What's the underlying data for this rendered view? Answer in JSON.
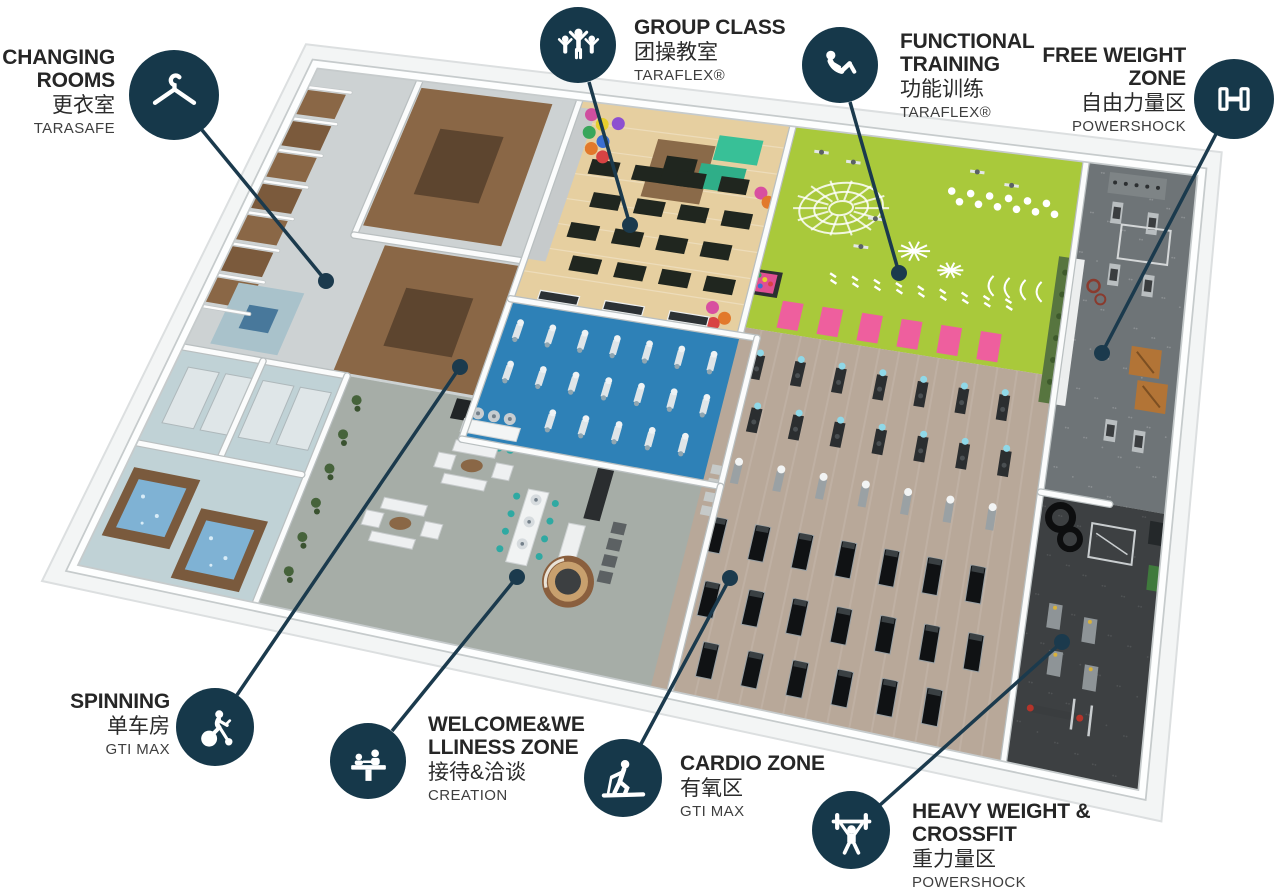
{
  "page": {
    "width": 1280,
    "height": 889,
    "background": "#ffffff"
  },
  "colors": {
    "label_circle": "#16384a",
    "leader_line": "#1b3a4d",
    "title_text": "#262626",
    "cn_text": "#2b2b2b",
    "brand_text": "#3e3e3e",
    "accent_pink": "#ee5f9e",
    "accent_teal": "#38c097",
    "wood_brown": "#8a6746"
  },
  "zones": [
    {
      "id": "changing-rooms",
      "color": "#cdd2d3"
    },
    {
      "id": "wet-area",
      "color": "#c0d2d6"
    },
    {
      "id": "welcome-wellness",
      "color": "#a6ada7"
    },
    {
      "id": "group-class",
      "color": "#e6cfa0"
    },
    {
      "id": "spinning",
      "color": "#2e81b7"
    },
    {
      "id": "functional-training",
      "color": "#a9c93b"
    },
    {
      "id": "cardio",
      "color": "#b8a899"
    },
    {
      "id": "free-weight",
      "color": "#6e7477"
    },
    {
      "id": "heavy-weight-crossfit",
      "color": "#3d4042"
    }
  ],
  "labels": [
    {
      "id": "changing-rooms",
      "title_lines": [
        "CHANGING",
        "ROOMS"
      ],
      "cn": "更衣室",
      "brand": "TARASAFE",
      "icon": "hanger-icon",
      "side": "right",
      "anchor_x": 115,
      "text_top": 46,
      "circle": {
        "x": 174,
        "y": 95,
        "r": 45
      },
      "leader": {
        "x1": 202,
        "y1": 130,
        "x2": 326,
        "y2": 281
      }
    },
    {
      "id": "group-class",
      "title_lines": [
        "GROUP CLASS"
      ],
      "cn": "团操教室",
      "brand": "TARAFLEX®",
      "icon": "group-class-icon",
      "side": "left",
      "anchor_x": 634,
      "text_top": 16,
      "circle": {
        "x": 578,
        "y": 45,
        "r": 38
      },
      "leader": {
        "x1": 589,
        "y1": 82,
        "x2": 630,
        "y2": 225
      }
    },
    {
      "id": "functional-training",
      "title_lines": [
        "FUNCTIONAL",
        "TRAINING"
      ],
      "cn": "功能训练",
      "brand": "TARAFLEX®",
      "icon": "situp-icon",
      "side": "left",
      "anchor_x": 900,
      "text_top": 30,
      "circle": {
        "x": 840,
        "y": 65,
        "r": 38
      },
      "leader": {
        "x1": 850,
        "y1": 102,
        "x2": 899,
        "y2": 273
      }
    },
    {
      "id": "free-weight-zone",
      "title_lines": [
        "FREE WEIGHT",
        "ZONE"
      ],
      "cn": "自由力量区",
      "brand": "POWERSHOCK",
      "icon": "dumbbell-icon",
      "side": "right",
      "anchor_x": 1186,
      "text_top": 44,
      "circle": {
        "x": 1234,
        "y": 99,
        "r": 40
      },
      "leader": {
        "x1": 1216,
        "y1": 134,
        "x2": 1102,
        "y2": 353
      }
    },
    {
      "id": "spinning",
      "title_lines": [
        "SPINNING"
      ],
      "cn": "单车房",
      "brand": "GTI MAX",
      "icon": "spin-bike-icon",
      "side": "right",
      "anchor_x": 170,
      "text_top": 690,
      "circle": {
        "x": 215,
        "y": 727,
        "r": 39
      },
      "leader": {
        "x1": 237,
        "y1": 695,
        "x2": 460,
        "y2": 367
      }
    },
    {
      "id": "welcome-wellness",
      "title_lines": [
        "WELCOME&WE",
        "LLINESS ZONE"
      ],
      "cn": "接待&洽谈",
      "brand": "CREATION",
      "icon": "reception-icon",
      "side": "left",
      "anchor_x": 428,
      "text_top": 713,
      "circle": {
        "x": 368,
        "y": 761,
        "r": 38
      },
      "leader": {
        "x1": 392,
        "y1": 731,
        "x2": 517,
        "y2": 577
      }
    },
    {
      "id": "cardio-zone",
      "title_lines": [
        "CARDIO ZONE"
      ],
      "cn": "有氧区",
      "brand": "GTI MAX",
      "icon": "treadmill-icon",
      "side": "left",
      "anchor_x": 680,
      "text_top": 752,
      "circle": {
        "x": 623,
        "y": 778,
        "r": 39
      },
      "leader": {
        "x1": 641,
        "y1": 744,
        "x2": 730,
        "y2": 578
      }
    },
    {
      "id": "heavy-weight-crossfit",
      "title_lines": [
        "HEAVY WEIGHT &",
        "CROSSFIT"
      ],
      "cn": "重力量区",
      "brand": "POWERSHOCK",
      "icon": "barbell-icon",
      "side": "left",
      "anchor_x": 912,
      "text_top": 800,
      "circle": {
        "x": 851,
        "y": 830,
        "r": 39
      },
      "leader": {
        "x1": 880,
        "y1": 805,
        "x2": 1062,
        "y2": 642
      }
    }
  ]
}
